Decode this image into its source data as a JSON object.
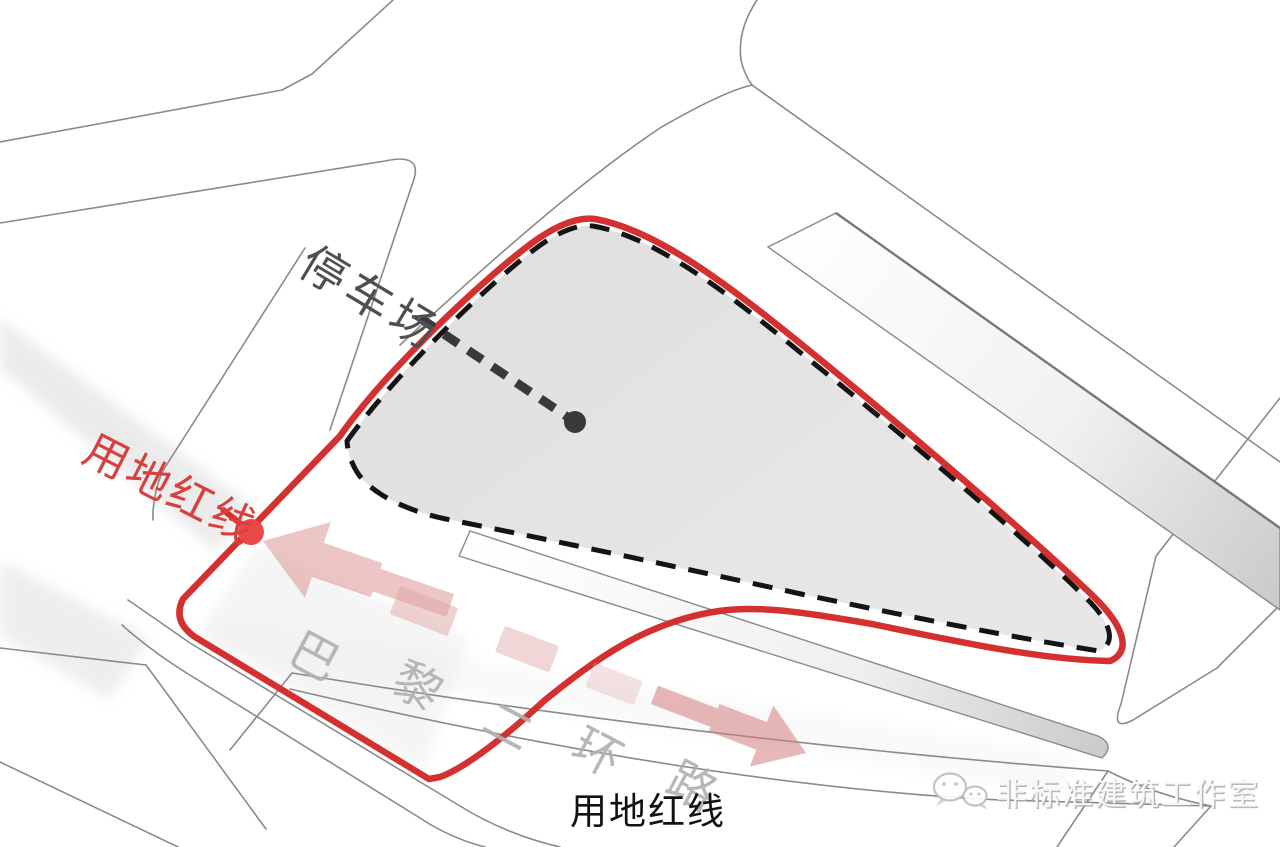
{
  "diagram": {
    "title": "site-boundary-analysis-diagram",
    "labels": {
      "parking": "停车场",
      "red_line_left": "用地红线",
      "red_line_bottom": "用地红线",
      "road_name": "巴黎二环路",
      "road_name_chars": [
        "巴",
        "黎",
        "二",
        "环",
        "路"
      ]
    },
    "watermark": {
      "icon": "wechat-icon",
      "text": "非标准建筑工作室"
    },
    "colors": {
      "red_line": "#d43030",
      "red_dot": "#ea4a46",
      "red_label": "#d84040",
      "site_fill": "#e3e3e3",
      "site_outline_dash": "#141414",
      "leader": "#3a3a3a",
      "road_line": "#8a8a8a",
      "arrow_pink": "#d98c8c",
      "road_text": "#b0b0b0",
      "parking_label": "#4f4f4f",
      "bottom_label": "#111111",
      "watermark_text": "#f7f7f7",
      "watermark_shadow": "#ababab"
    }
  }
}
